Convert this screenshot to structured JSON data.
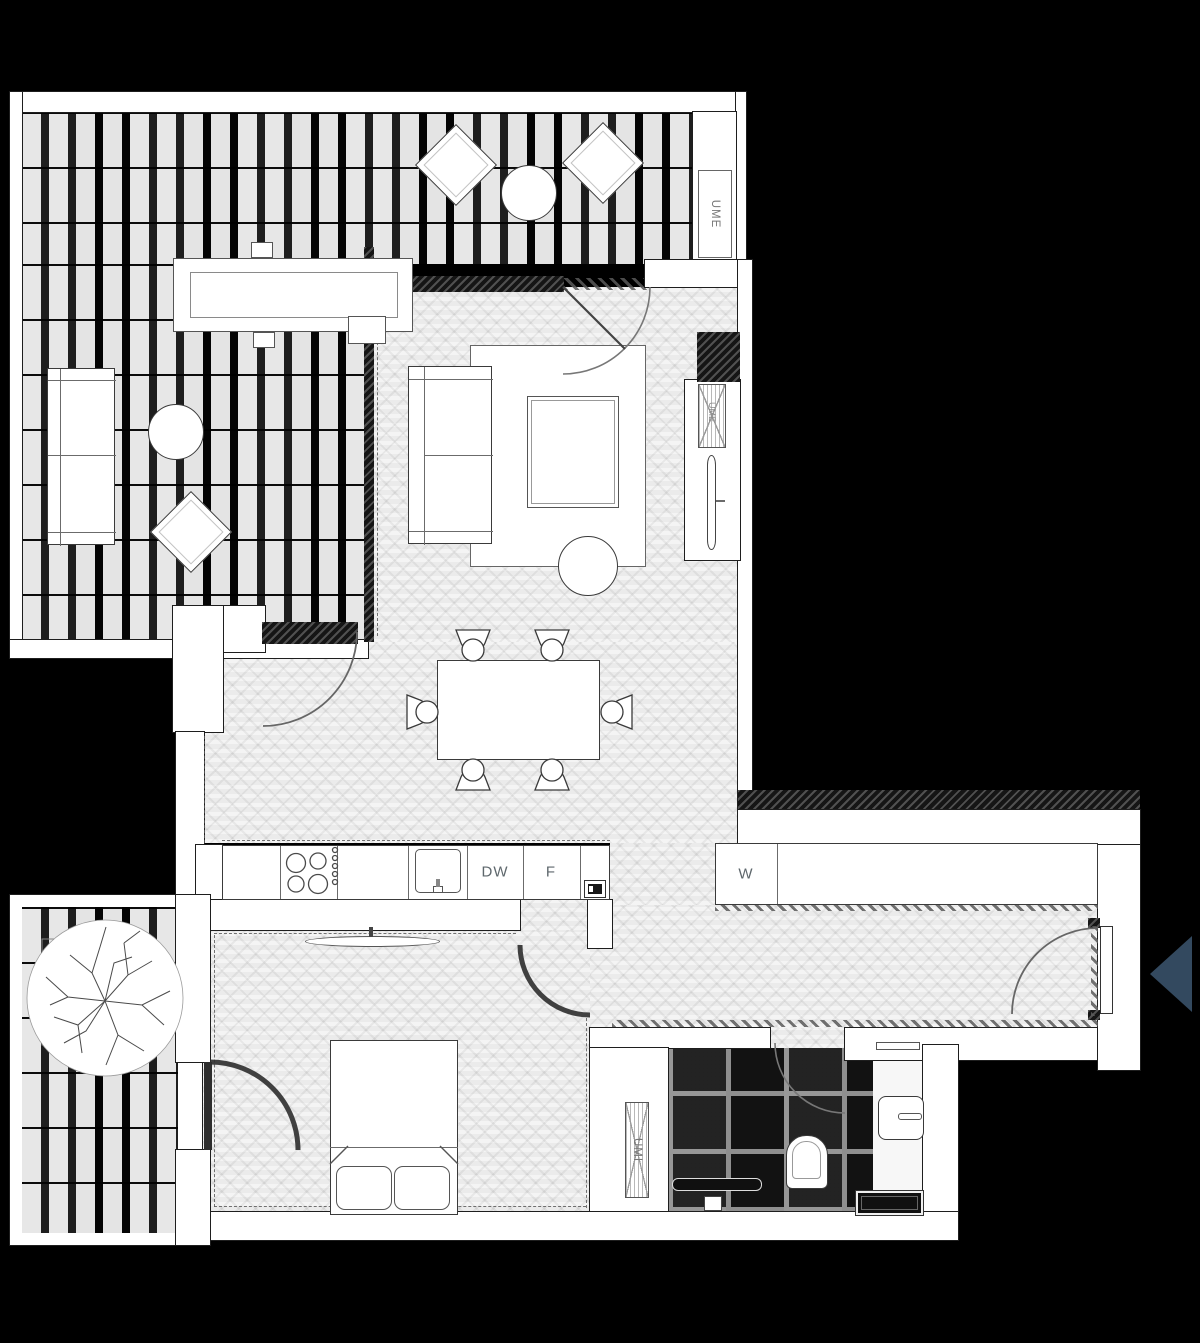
{
  "plan": {
    "background_color": "#000000",
    "wall_color": "#ffffff",
    "floor_color": "#ebebeb",
    "entry_arrow_color": "#33495f",
    "label_color": "#5e676c"
  },
  "labels": {
    "terrace_unit": "UME",
    "living_room_unit": "UME",
    "bathroom_unit": "UMI",
    "dishwasher": "DW",
    "fridge": "F",
    "washing_column": "W"
  }
}
